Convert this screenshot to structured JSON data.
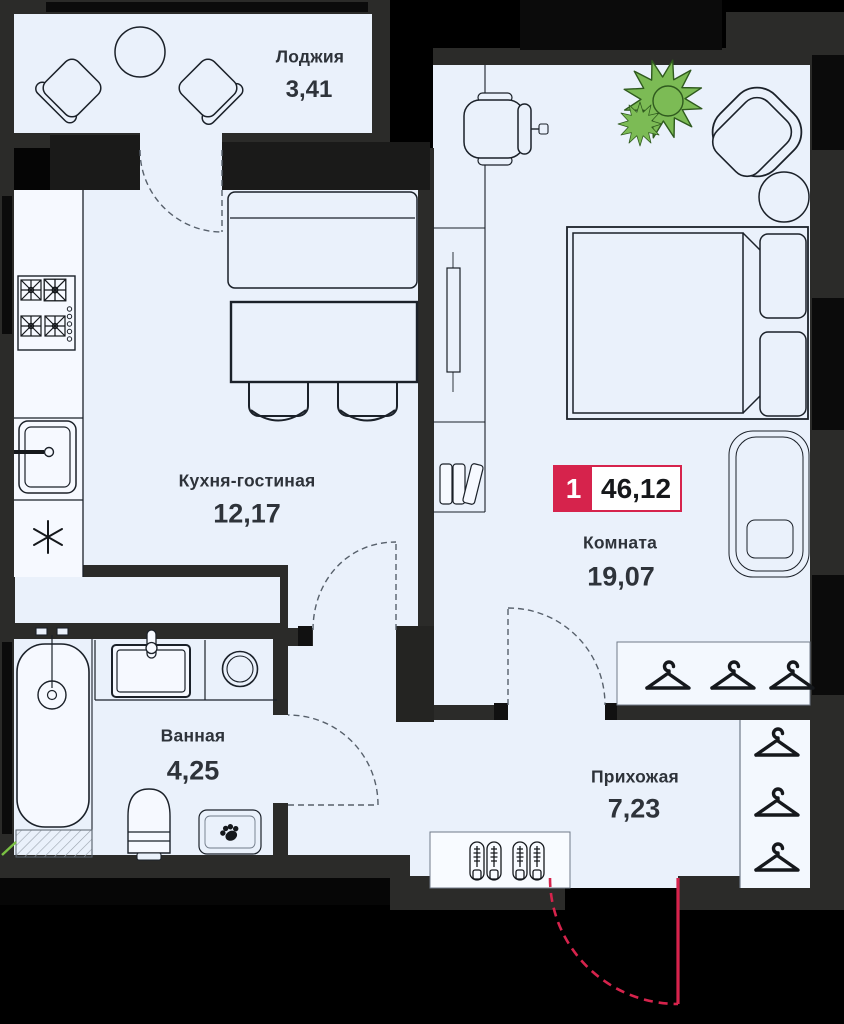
{
  "floorplan": {
    "badge": {
      "number": "1",
      "area": "46,12"
    },
    "rooms": [
      {
        "key": "loggia",
        "name": "Лоджия",
        "area": "3,41"
      },
      {
        "key": "kitchen",
        "name": "Кухня-гостиная",
        "area": "12,17"
      },
      {
        "key": "room",
        "name": "Комната",
        "area": "19,07"
      },
      {
        "key": "bathroom",
        "name": "Ванная",
        "area": "4,25"
      },
      {
        "key": "hallway",
        "name": "Прихожая",
        "area": "7,23"
      }
    ],
    "colors": {
      "accent": "#d6234c",
      "wall": "#2b2b29",
      "floor": "#eaf1fb",
      "plant": "#7cbb55",
      "outside": "#000000"
    }
  }
}
